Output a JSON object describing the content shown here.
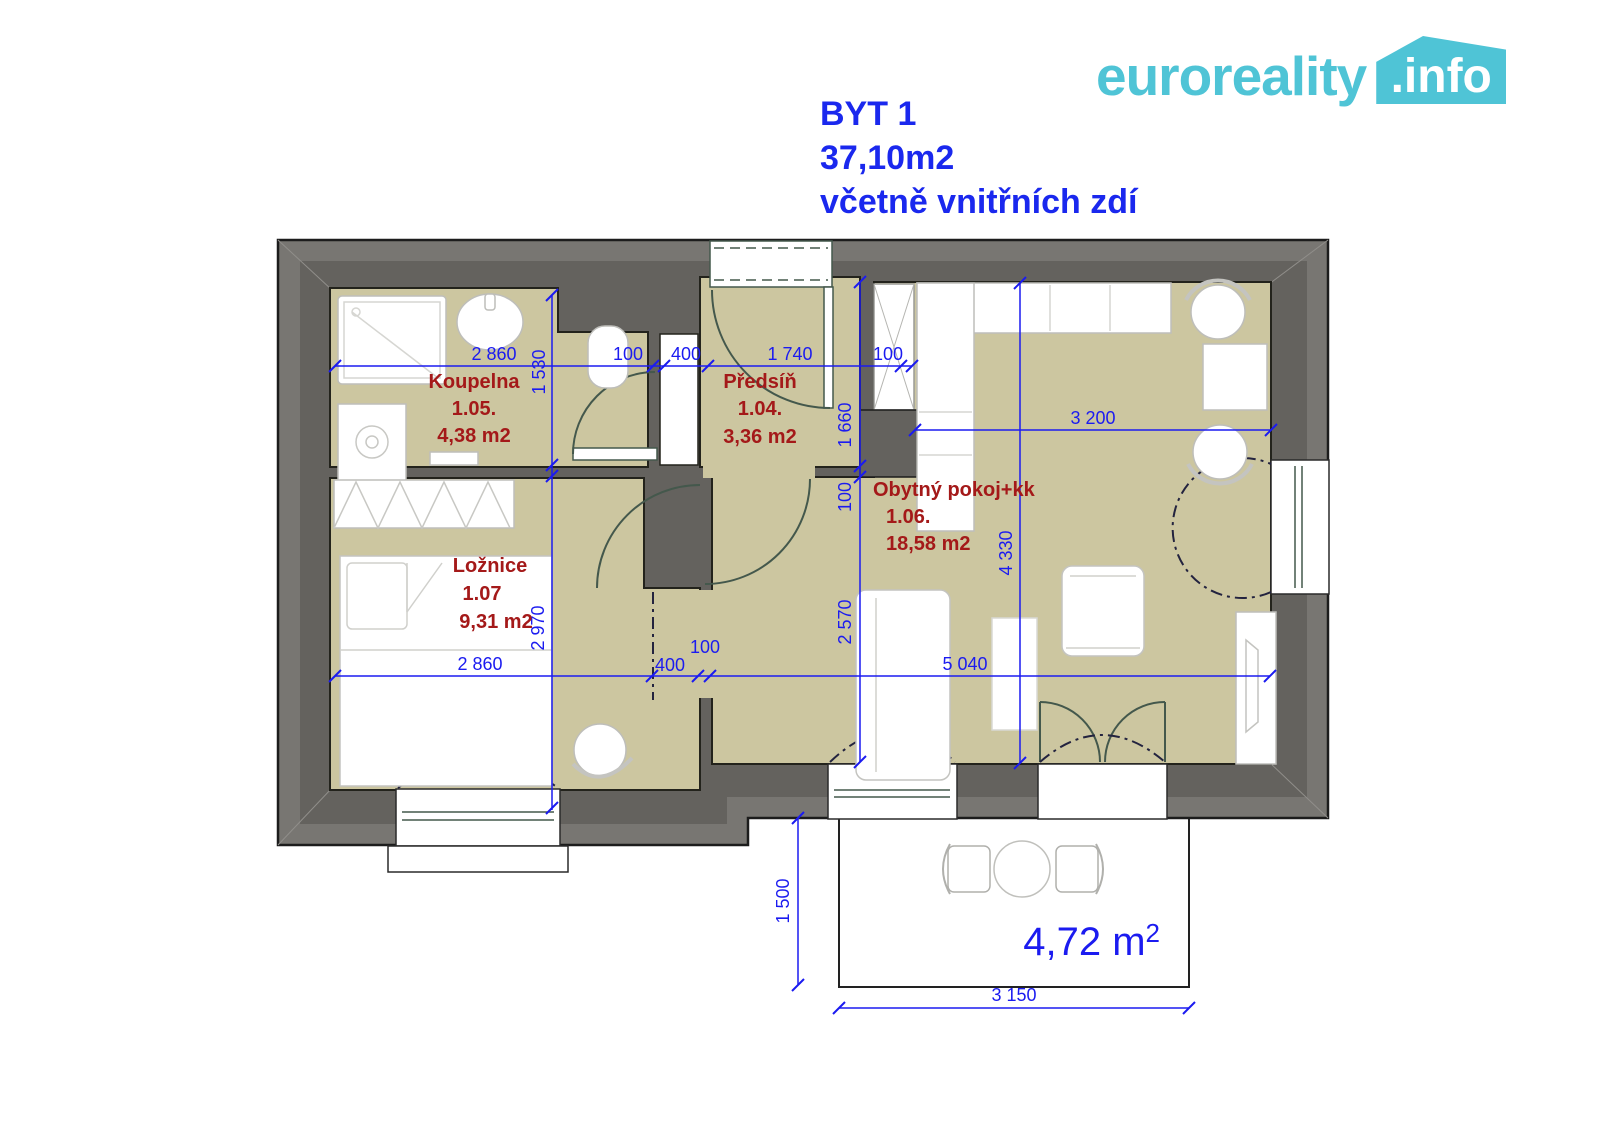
{
  "logo": {
    "brand": "euroreality",
    "tld": ".info"
  },
  "title": {
    "apartment": "BYT 1",
    "area": "37,10m2",
    "note": "včetně vnitřních zdí"
  },
  "rooms": {
    "koupelna": {
      "name": "Koupelna",
      "number": "1.05.",
      "area": "4,38 m2"
    },
    "predsin": {
      "name": "Předsíň",
      "number": "1.04.",
      "area": "3,36 m2"
    },
    "loznice": {
      "name": "Ložnice",
      "number": "1.07",
      "area": "9,31 m2"
    },
    "obytny": {
      "name": "Obytný pokoj+kk",
      "number": "1.06.",
      "area": "18,58 m2"
    }
  },
  "terrace": {
    "area_label": "4,72 m",
    "area_sup": "2"
  },
  "dims": {
    "bath_width": "2 860",
    "bath_height": "1 530",
    "wc_wall": "100",
    "shaft_width": "400",
    "hall_width": "1 740",
    "hall_height": "1 660",
    "hall_wall": "100",
    "living_wall_top": "100",
    "living_top_width": "3 200",
    "living_height": "4 330",
    "bed_height": "2 970",
    "bed_width": "2 860",
    "bed_niche": "400",
    "bed_wall": "100",
    "living_mid_height": "2 570",
    "living_width": "5 040",
    "terrace_height": "1 500",
    "terrace_width": "3 150"
  },
  "colors": {
    "dimension_blue": "#1b1bf0",
    "room_label_red": "#a41919",
    "brand_teal": "#4fc4d6",
    "wall_gray_outer": "#787672",
    "wall_gray_inner": "#64625e",
    "floor_khaki": "#ccc6a0"
  }
}
